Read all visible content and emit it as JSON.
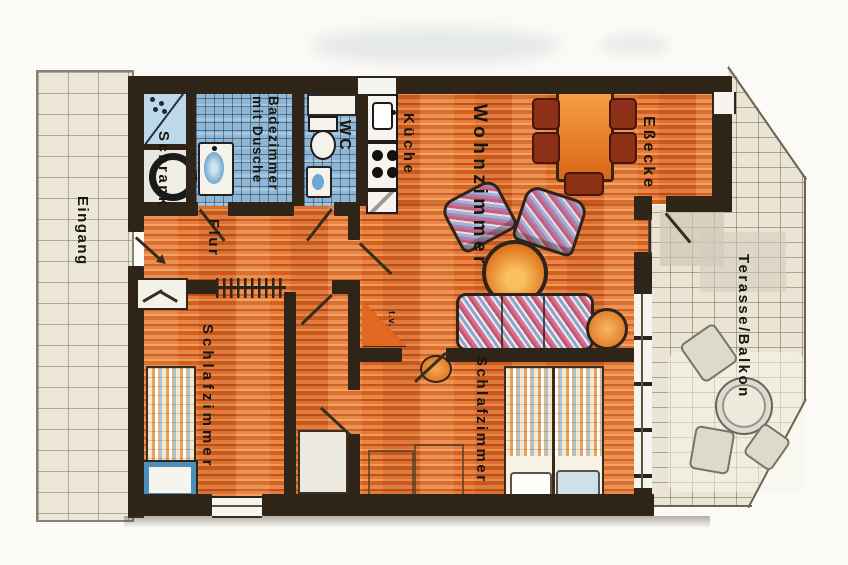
{
  "floorplan": {
    "labels": {
      "eingang": "Eingang",
      "schrank": "Schrank",
      "badezimmer_line1": "Badezimmer",
      "badezimmer_line2": "mit Dusche",
      "wc": "WC",
      "kueche": "Küche",
      "wohnzimmer": "Wohnzimmer",
      "essecke": "Eßecke",
      "flur": "Flur",
      "schlafzimmer_links": "Schlafzimmer",
      "schlafzimmer_rechts": "Schlafzimmer",
      "terrasse_balkon": "Terasse/Balkon",
      "tv": "t.v."
    },
    "colors": {
      "wall": "#2e2418",
      "wood_floor": "#d96a2e",
      "bath_tile": "#8fb6d2",
      "outdoor_tile": "#e9e4d3",
      "furniture_orange": "#e8802e",
      "dining_chair_red": "#8c3018",
      "bed_frame_blue": "#4a90b8",
      "label_text": "#17150f"
    }
  }
}
